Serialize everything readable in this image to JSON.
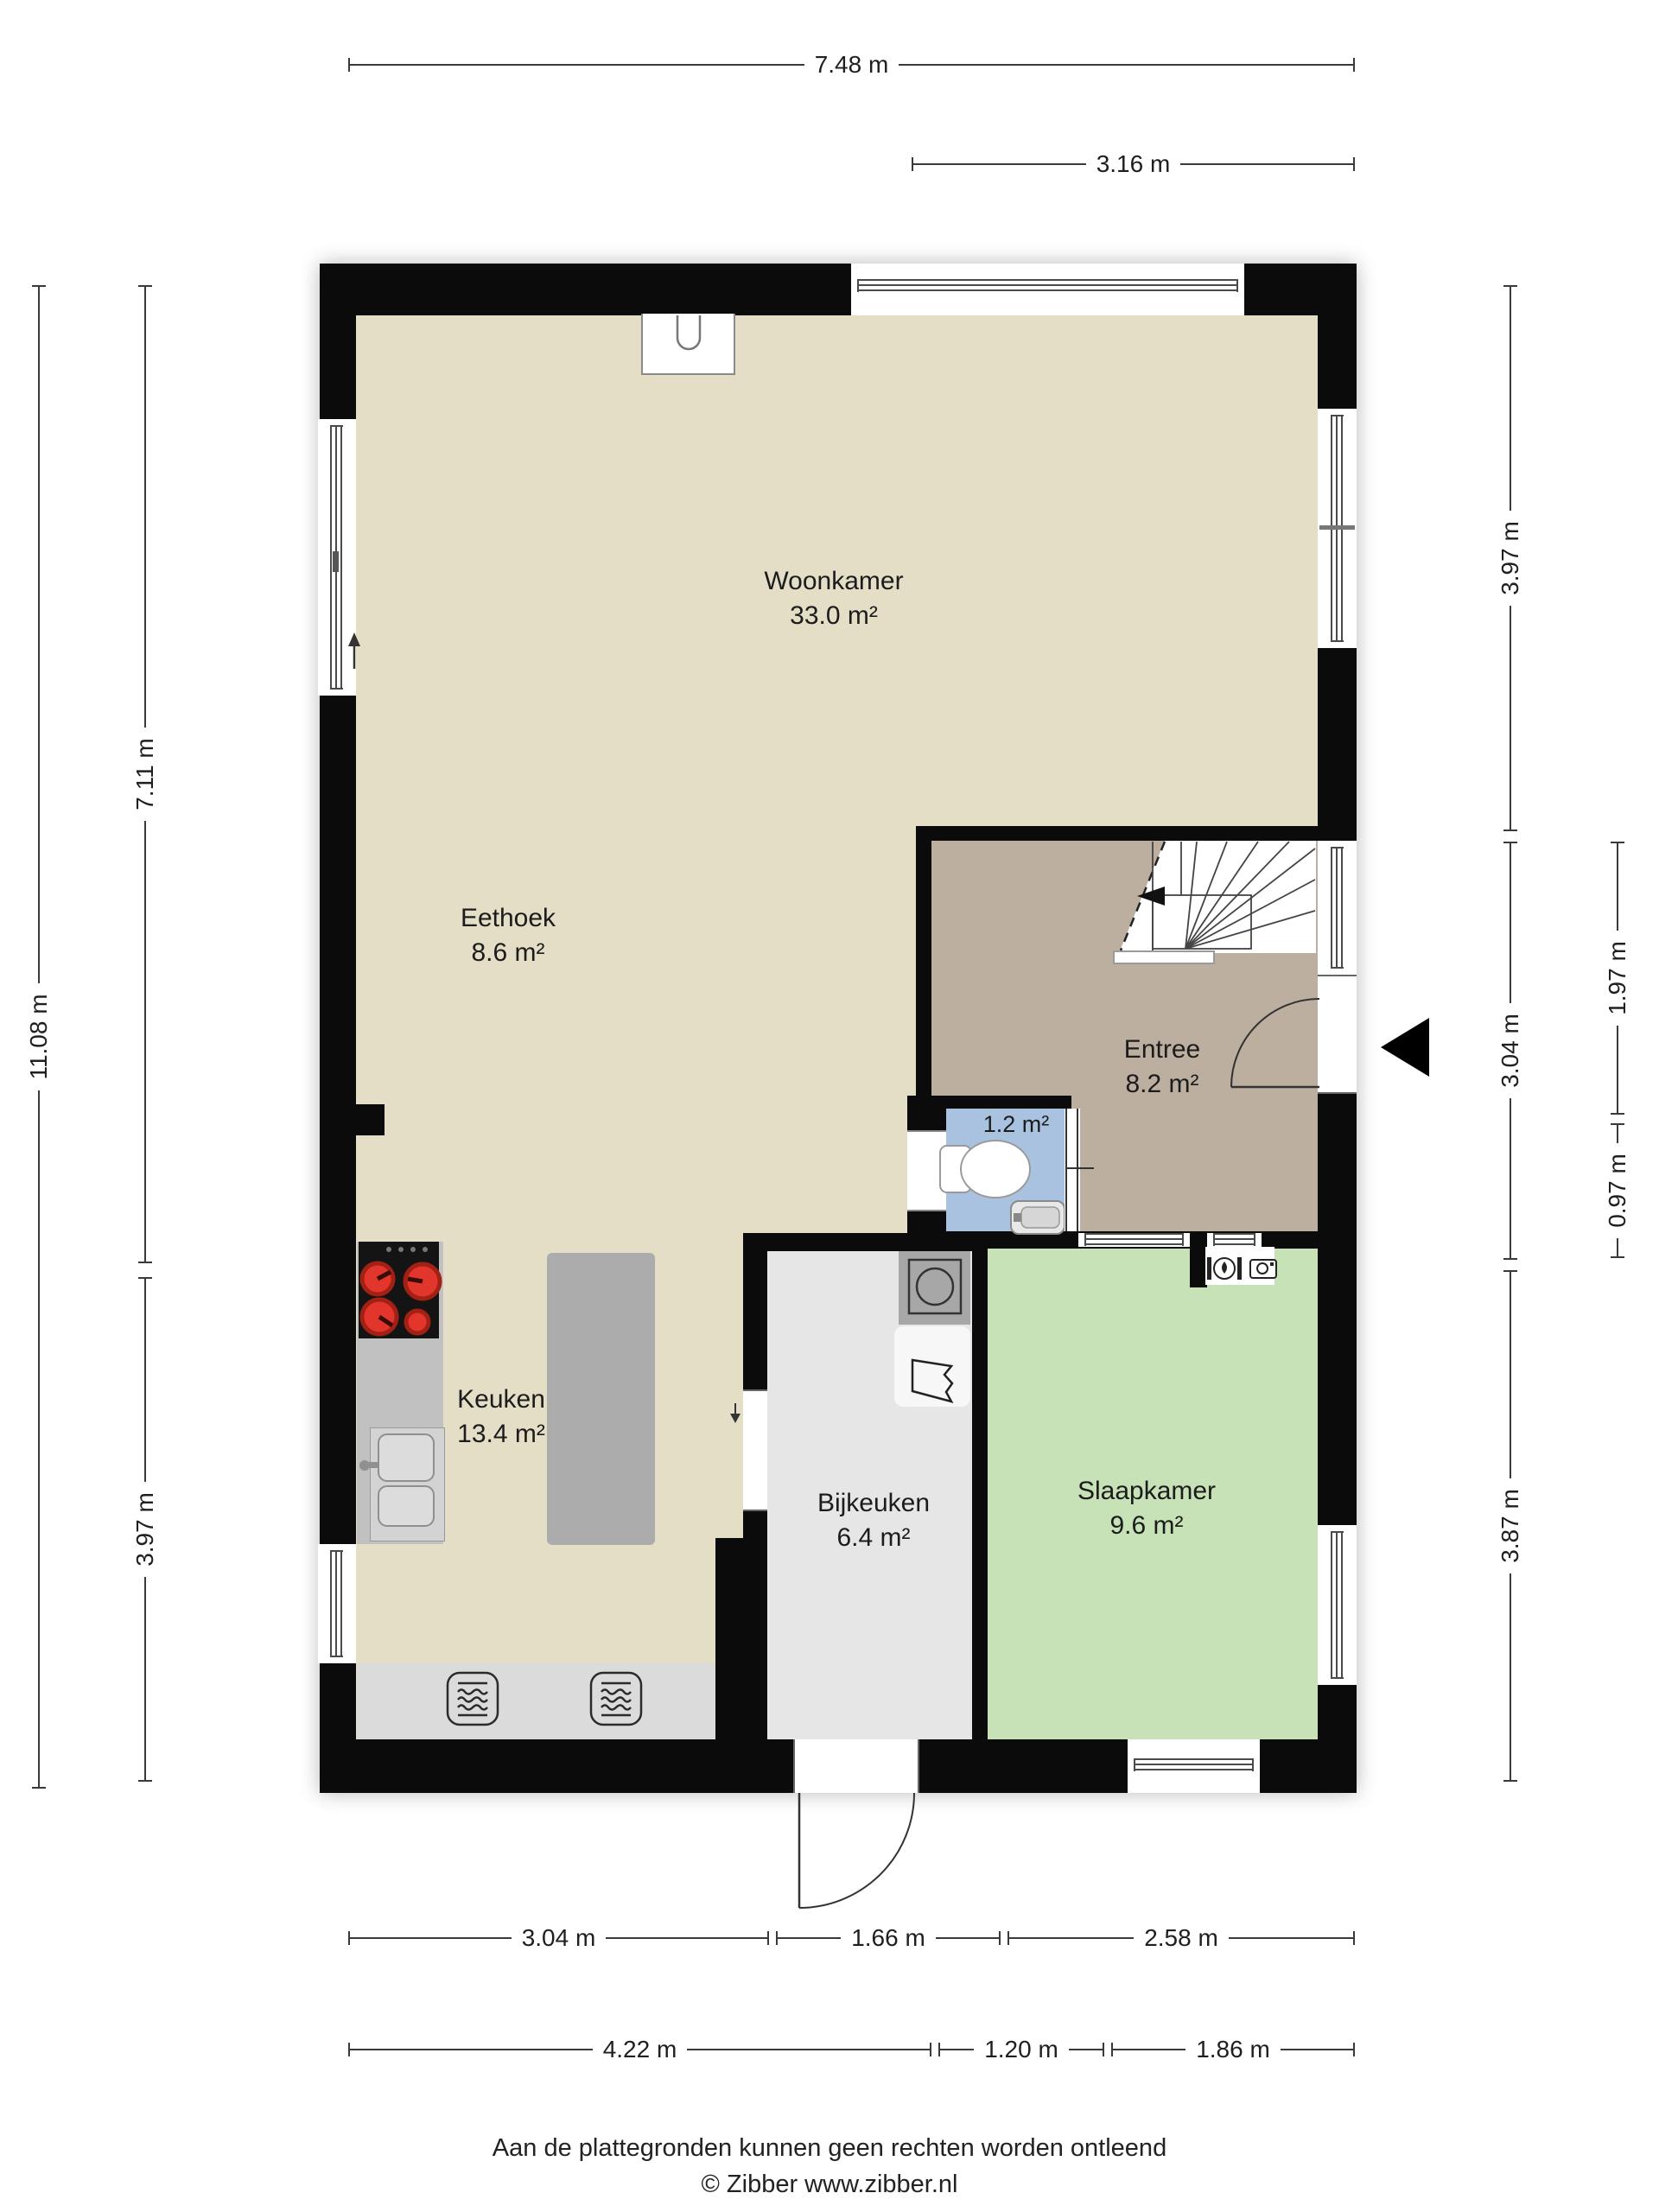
{
  "rooms": {
    "woonkamer": {
      "name": "Woonkamer",
      "area": "33.0 m²",
      "color": "#e4dec6"
    },
    "eethoek": {
      "name": "Eethoek",
      "area": "8.6 m²",
      "color": "#e4dec6"
    },
    "entree": {
      "name": "Entree",
      "area": "8.2 m²",
      "color": "#bdafa0"
    },
    "toilet": {
      "area": "1.2 m²",
      "color": "#a9c2df"
    },
    "keuken": {
      "name": "Keuken",
      "area": "13.4 m²",
      "color": "#e4dec6"
    },
    "bijkeuken": {
      "name": "Bijkeuken",
      "area": "6.4 m²",
      "color": "#e6e6e6"
    },
    "slaapkamer": {
      "name": "Slaapkamer",
      "area": "9.6 m²",
      "color": "#c7e2b6"
    }
  },
  "dimensions": {
    "top_overall": "7.48 m",
    "top_right": "3.16 m",
    "left_overall": "11.08 m",
    "left_upper": "7.11 m",
    "left_lower": "3.97 m",
    "right_upper": "3.97 m",
    "right_middle": "3.04 m",
    "right_lower": "3.87 m",
    "right_inner_upper": "1.97 m",
    "right_inner_lower": "0.97 m",
    "bottom_inner": [
      "3.04 m",
      "1.66 m",
      "2.58 m"
    ],
    "bottom_outer": [
      "4.22 m",
      "1.20 m",
      "1.86 m"
    ]
  },
  "footer": {
    "disclaimer": "Aan de plattegronden kunnen geen rechten worden ontleend",
    "copyright": "© Zibber www.zibber.nl"
  },
  "colors": {
    "wall": "#0b0b0b",
    "dimension_line": "#3a3a3a",
    "burner_red": "#e2352b"
  }
}
